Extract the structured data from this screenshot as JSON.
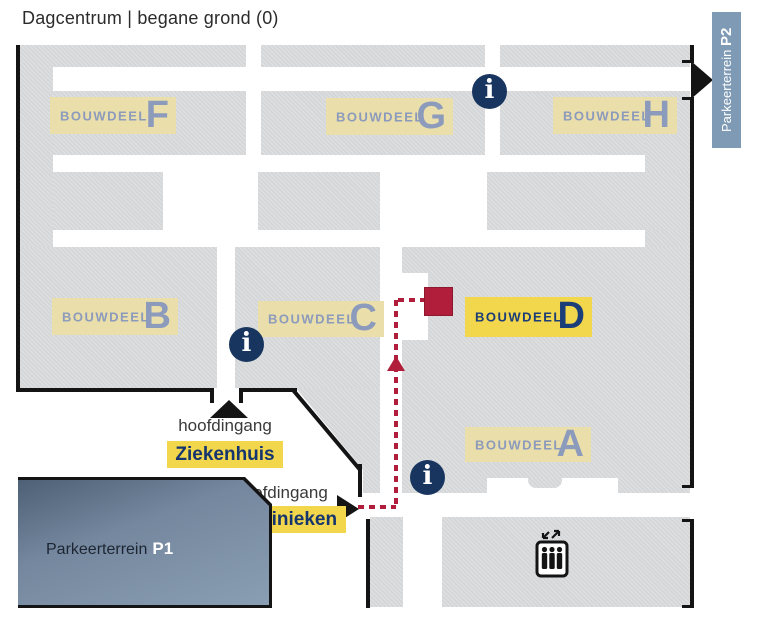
{
  "title": "Dagcentrum | begane grond (0)",
  "buildings": {
    "f": {
      "word": "BOUWDEEL",
      "letter": "F",
      "highlighted": false
    },
    "g": {
      "word": "BOUWDEEL",
      "letter": "G",
      "highlighted": false
    },
    "h": {
      "word": "BOUWDEEL",
      "letter": "H",
      "highlighted": false
    },
    "b": {
      "word": "BOUWDEEL",
      "letter": "B",
      "highlighted": false
    },
    "c": {
      "word": "BOUWDEEL",
      "letter": "C",
      "highlighted": false
    },
    "d": {
      "word": "BOUWDEEL",
      "letter": "D",
      "highlighted": true
    },
    "a": {
      "word": "BOUWDEEL",
      "letter": "A",
      "highlighted": false
    }
  },
  "entrances": {
    "ziekenhuis": {
      "line1": "hoofdingang",
      "line2": "Ziekenhuis"
    },
    "poliklinieken": {
      "line1": "hoofdingang",
      "line2": "Poliklinieken"
    }
  },
  "parking": {
    "p1": {
      "name": "Parkeerterrein",
      "code": "P1"
    },
    "p2": {
      "name": "Parkeerterrein",
      "code": "P2"
    }
  },
  "icons": {
    "info": "i"
  },
  "colors": {
    "route": "#b01e3c",
    "highlight_yellow": "#f2d64b",
    "label_yellow": "#eadfab",
    "navy": "#17355e",
    "building_gray": "#d4d6d8",
    "p1_blue": "#74879e",
    "p2_blue": "#7f9ab5"
  }
}
